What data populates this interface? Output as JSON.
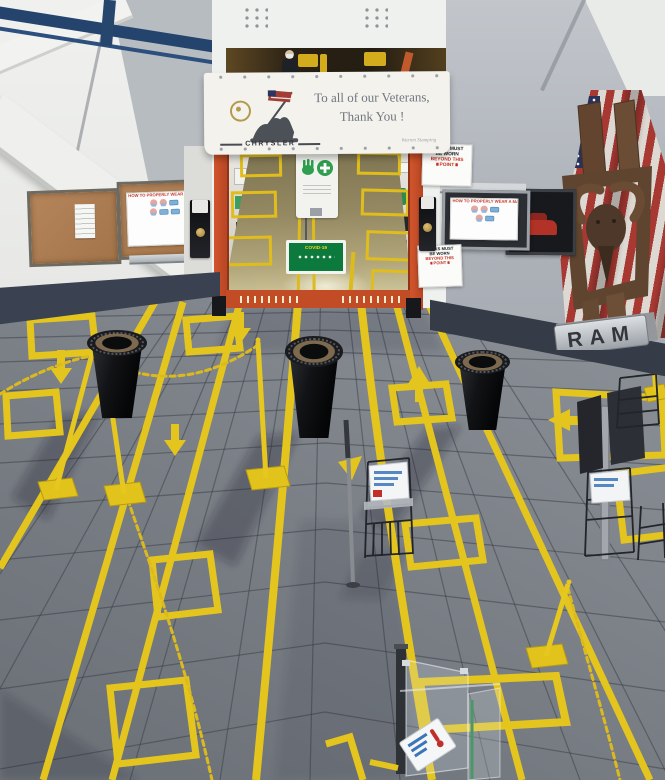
{
  "banner": {
    "line1": "To all of our Veterans,",
    "line2": "Thank You !",
    "brand": "CHRYSLER",
    "signature": "Warren Stamping"
  },
  "mask_sign": {
    "line1": "MASKS MUST",
    "line2": "BE WORN",
    "line3": "BEYOND THIS",
    "line4": "POINT"
  },
  "mask_poster": {
    "title": "HOW TO PROPERLY WEAR A MASK"
  },
  "ram_sign": {
    "label": "RAM"
  },
  "covid_sign": {
    "label": "COVID-19"
  },
  "colors": {
    "tape_yellow": "#e4c51e",
    "chain_yellow": "#dcba1e",
    "floor_gray": "#7c8188",
    "wall_gray": "#b6bbc1",
    "wall_white": "#ecedeb",
    "base_band_dark": "#353c47",
    "orange_frame": "#c24c26",
    "flag_red": "#a83832",
    "flag_blue": "#2a3158",
    "rust_brown": "#6b4c34",
    "sign_red": "#c23020",
    "green_sign": "#0c7a3c",
    "ramp_tan": "#948962",
    "railing_blue": "#24446e"
  },
  "icons": {
    "ram_head": "ram-head-icon",
    "us_flag": "us-flag-icon",
    "iwo_jima": "iwo-jima-memorial-icon",
    "hand_wash": "hand-wash-icon",
    "uaw_emblem": "gold-round-emblem-icon"
  }
}
